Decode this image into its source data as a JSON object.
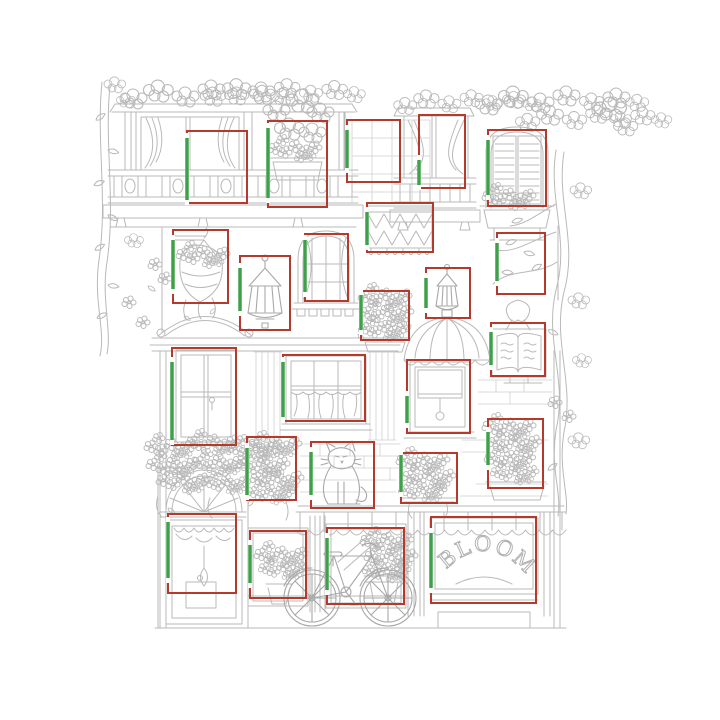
{
  "shop": {
    "sign_text": "BLOOMS"
  },
  "annotation": {
    "box_color": "#b43a2e",
    "accent_color": "#3fa04a",
    "line_color": "#b9b9b9",
    "boxes": [
      {
        "name": "balcony-window-left",
        "x": 187,
        "y": 131,
        "w": 60,
        "h": 72,
        "gy": 138,
        "gh": 62
      },
      {
        "name": "balcony-planter",
        "x": 268,
        "y": 121,
        "w": 59,
        "h": 86,
        "gy": 128,
        "gh": 70
      },
      {
        "name": "balcony-window-right",
        "x": 347,
        "y": 120,
        "w": 53,
        "h": 62,
        "gy": 130,
        "gh": 38
      },
      {
        "name": "balcony-window-far-right",
        "x": 419,
        "y": 115,
        "w": 46,
        "h": 73,
        "gy": 160,
        "gh": 25
      },
      {
        "name": "shuttered-window",
        "x": 488,
        "y": 130,
        "w": 58,
        "h": 76,
        "gy": 140,
        "gh": 55
      },
      {
        "name": "zigzag-valance",
        "x": 367,
        "y": 203,
        "w": 66,
        "h": 49,
        "gy": 212,
        "gh": 33
      },
      {
        "name": "hanging-basket",
        "x": 173,
        "y": 230,
        "w": 55,
        "h": 73,
        "gy": 240,
        "gh": 49
      },
      {
        "name": "wall-lantern-left",
        "x": 240,
        "y": 256,
        "w": 50,
        "h": 74,
        "gy": 268,
        "gh": 43
      },
      {
        "name": "arched-window",
        "x": 305,
        "y": 234,
        "w": 43,
        "h": 67,
        "gy": 240,
        "gh": 52
      },
      {
        "name": "flower-box-upper",
        "x": 361,
        "y": 291,
        "w": 48,
        "h": 49,
        "gy": 295,
        "gh": 35
      },
      {
        "name": "wall-lantern-right",
        "x": 426,
        "y": 268,
        "w": 44,
        "h": 50,
        "gy": 278,
        "gh": 30
      },
      {
        "name": "vine-branches",
        "x": 497,
        "y": 233,
        "w": 48,
        "h": 61,
        "gy": 243,
        "gh": 38
      },
      {
        "name": "menu-board",
        "x": 491,
        "y": 323,
        "w": 54,
        "h": 53,
        "gy": 332,
        "gh": 33
      },
      {
        "name": "tall-window",
        "x": 172,
        "y": 348,
        "w": 64,
        "h": 97,
        "gy": 362,
        "gh": 78
      },
      {
        "name": "center-window",
        "x": 283,
        "y": 355,
        "w": 82,
        "h": 66,
        "gy": 362,
        "gh": 55
      },
      {
        "name": "shade-window",
        "x": 407,
        "y": 360,
        "w": 63,
        "h": 73,
        "gy": 396,
        "gh": 27
      },
      {
        "name": "flower-box-left",
        "x": 247,
        "y": 437,
        "w": 49,
        "h": 63,
        "gy": 448,
        "gh": 47
      },
      {
        "name": "cat-ledge",
        "x": 311,
        "y": 442,
        "w": 63,
        "h": 66,
        "gy": 452,
        "gh": 43
      },
      {
        "name": "flower-box-mid",
        "x": 401,
        "y": 453,
        "w": 56,
        "h": 50,
        "gy": 455,
        "gh": 37
      },
      {
        "name": "flower-box-right",
        "x": 488,
        "y": 419,
        "w": 55,
        "h": 69,
        "gy": 432,
        "gh": 33
      },
      {
        "name": "entry-door",
        "x": 168,
        "y": 514,
        "w": 68,
        "h": 79,
        "gy": 522,
        "gh": 56
      },
      {
        "name": "shop-window-left",
        "x": 250,
        "y": 531,
        "w": 56,
        "h": 67,
        "gy": 545,
        "gh": 38
      },
      {
        "name": "shop-window-right",
        "x": 327,
        "y": 528,
        "w": 77,
        "h": 76,
        "gy": 538,
        "gh": 52
      },
      {
        "name": "blooms-sign",
        "x": 431,
        "y": 517,
        "w": 105,
        "h": 86,
        "gy": 533,
        "gh": 55
      }
    ]
  }
}
